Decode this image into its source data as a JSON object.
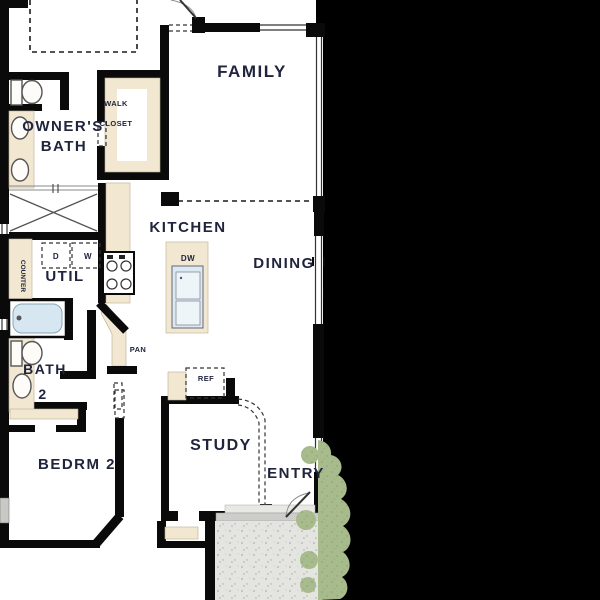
{
  "plan": {
    "labels": {
      "family": "FAMILY",
      "owners_bath_1": "OWNER'S",
      "owners_bath_2": "BATH",
      "walk_1": "WALK",
      "walk_2": "CLOSET",
      "kitchen": "KITCHEN",
      "dining": "DINING",
      "util": "UTIL",
      "counter": "COUNTER",
      "dryer": "D",
      "washer": "W",
      "dishwasher": "DW",
      "pantry": "PAN",
      "refrigerator": "REF",
      "bath2_1": "BATH",
      "bath2_2": "2",
      "bedroom2": "BEDRM 2",
      "study": "STUDY",
      "entry": "ENTRY"
    },
    "colors": {
      "background": "#000000",
      "floor": "#ffffff",
      "wall": "#0a0a0a",
      "casework": "#f2e7d0",
      "fixture_blue": "#d6e7f2",
      "porch_concrete": "#e4e4e1",
      "landscape_green": "#a8bb8c",
      "window_gray": "#c8c8c5",
      "label_text": "#20243d"
    }
  }
}
